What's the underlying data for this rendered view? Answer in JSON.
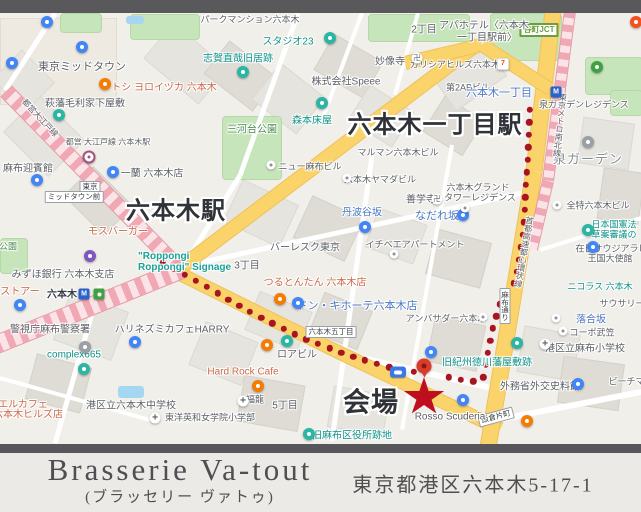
{
  "footer": {
    "name": "Brasserie Va-tout",
    "kana": "(ブラッセリー ヴァトゥ)",
    "address": "東京都港区六本木5-17-1"
  },
  "map": {
    "big_labels": [
      {
        "text": "六本木一丁目駅",
        "x": 435,
        "y": 122,
        "size": 24
      },
      {
        "text": "六本木駅",
        "x": 176,
        "y": 208,
        "size": 24
      },
      {
        "text": "会場",
        "x": 371,
        "y": 400,
        "size": 27
      }
    ],
    "signage": {
      "lines": [
        "\"Roppongi",
        "Roppongi\" Signage"
      ],
      "x": 138,
      "y": 251,
      "color": "#18a295"
    },
    "labels": [
      [
        "パークマンション六本木",
        250,
        19,
        "g",
        9
      ],
      [
        "東京ミッドタウン",
        82,
        66,
        "g",
        11
      ],
      [
        "トシ ヨロイヅカ 六本木",
        164,
        86,
        "o",
        10
      ],
      [
        "萩藩毛利家下屋敷",
        85,
        102,
        "g",
        10
      ],
      [
        "志賀直哉旧居跡",
        238,
        57,
        "t",
        10
      ],
      [
        "スタジオ23",
        288,
        40,
        "t",
        10
      ],
      [
        "妙像寺",
        390,
        60,
        "g",
        10
      ],
      [
        "株式会社Speee",
        346,
        80,
        "g",
        10
      ],
      [
        "2丁目",
        424,
        28,
        "g",
        10
      ],
      [
        "アパホテル〈六本木",
        484,
        24,
        "g",
        10
      ],
      [
        "一丁目駅前〉",
        487,
        36,
        "g",
        10
      ],
      [
        "ガリシアヒルズ六本木",
        455,
        64,
        "g",
        9
      ],
      [
        "第2ABビル",
        468,
        87,
        "g",
        9
      ],
      [
        "六本木一丁目",
        499,
        92,
        "b",
        11
      ],
      [
        "泉ガーデンレジデンス",
        584,
        104,
        "g",
        9
      ],
      [
        "泉ガーデン",
        588,
        158,
        "area",
        13
      ],
      [
        "全特六本木ビル",
        598,
        205,
        "g",
        9
      ],
      [
        "日本国憲法",
        614,
        224,
        "t",
        9
      ],
      [
        "草案審議の",
        614,
        234,
        "t",
        9
      ],
      [
        "在日サウジアラビア",
        616,
        248,
        "g",
        9
      ],
      [
        "王国大使館",
        610,
        258,
        "g",
        9
      ],
      [
        "ニコラス 六本木",
        600,
        286,
        "t",
        9
      ],
      [
        "サウサリー",
        622,
        303,
        "g",
        9
      ],
      [
        "落合坂",
        591,
        318,
        "b",
        10
      ],
      [
        "コーポ武笠",
        592,
        332,
        "g",
        9
      ],
      [
        "港区立麻布小学校",
        585,
        347,
        "g",
        10
      ],
      [
        "外務省外交史料館",
        540,
        385,
        "g",
        10
      ],
      [
        "ビーチマン",
        631,
        381,
        "g",
        9
      ],
      [
        "麻布迎賓館",
        28,
        167,
        "g",
        10
      ],
      [
        "都営 大江戸線 六本木駅",
        108,
        142,
        "g",
        8
      ],
      [
        "一蘭 六本木店",
        152,
        172,
        "g",
        10
      ],
      [
        "モスバーガー",
        118,
        230,
        "o",
        10
      ],
      [
        "みずほ銀行 六本木支店",
        63,
        273,
        "g",
        10
      ],
      [
        "ストアー",
        20,
        290,
        "o",
        10
      ],
      [
        "六本木",
        62,
        293,
        "st",
        10
      ],
      [
        "警視庁麻布警察署",
        50,
        328,
        "g",
        10
      ],
      [
        "complex665",
        74,
        355,
        "t",
        10
      ],
      [
        "ハリネズミカフェHARRY",
        172,
        328,
        "g",
        10
      ],
      [
        "エルカフェ",
        23,
        403,
        "o",
        10
      ],
      [
        "六本木ヒルズ店",
        28,
        413,
        "o",
        10
      ],
      [
        "港区立六本木中学校",
        131,
        404,
        "g",
        10
      ],
      [
        "東洋英和女学院小学部",
        210,
        417,
        "g",
        9
      ],
      [
        "三河台公園",
        252,
        128,
        "grn",
        10
      ],
      [
        "森本床屋",
        312,
        119,
        "t",
        10
      ],
      [
        "ニュー麻布ビル",
        310,
        166,
        "g",
        9
      ],
      [
        "マルマン六本木ビル",
        398,
        152,
        "g",
        9
      ],
      [
        "六本木ヤマダビル",
        380,
        179,
        "g",
        9
      ],
      [
        "丹波谷坂",
        362,
        211,
        "b",
        10
      ],
      [
        "善学寺",
        421,
        198,
        "g",
        10
      ],
      [
        "なだれ坂",
        437,
        215,
        "b",
        11
      ],
      [
        "六本木グランド",
        478,
        187,
        "g",
        9
      ],
      [
        "タワーレジデンス",
        480,
        197,
        "g",
        9
      ],
      [
        "イチベエアパートメント",
        415,
        244,
        "g",
        9
      ],
      [
        "バーレスク東京",
        305,
        246,
        "g",
        10
      ],
      [
        "3丁目",
        247,
        264,
        "g",
        10
      ],
      [
        "つるとんたん 六本木店",
        315,
        281,
        "o",
        10
      ],
      [
        "ドン・キホーテ六本木店",
        357,
        305,
        "b",
        11
      ],
      [
        "アンバサダー六本木",
        446,
        318,
        "g",
        9
      ],
      [
        "ロアビル",
        297,
        353,
        "g",
        10
      ],
      [
        "Hard Rock Cafe",
        243,
        372,
        "o",
        10
      ],
      [
        "福龍",
        255,
        399,
        "g",
        9
      ],
      [
        "5丁目",
        285,
        404,
        "g",
        10
      ],
      [
        "旧麻布区役所跡地",
        352,
        434,
        "t",
        10
      ],
      [
        "Rosso Scuderia",
        450,
        417,
        "g",
        10
      ],
      [
        "旧紀州徳川藩屋敷跡",
        487,
        361,
        "t",
        10
      ],
      [
        "公園",
        8,
        246,
        "grn",
        9
      ],
      [
        "都営大江戸線",
        40,
        118,
        "g",
        8,
        47
      ],
      [
        "東京メトロ南北線",
        560,
        125,
        "g",
        8,
        6,
        true
      ],
      [
        "首都高速都心環状線",
        524,
        252,
        "g",
        8,
        10,
        true
      ]
    ],
    "boxes": [
      {
        "text": "谷町JCT",
        "x": 539,
        "y": 30,
        "cls": "jct"
      },
      {
        "text": "東京",
        "x": 90,
        "y": 187
      },
      {
        "text": "ミッドタウン前",
        "x": 74,
        "y": 197
      },
      {
        "text": "六本木五丁目",
        "x": 331,
        "y": 332
      },
      {
        "text": "飯倉片町",
        "x": 496,
        "y": 417,
        "rot": -15
      },
      {
        "text": "麻布通り",
        "x": 505,
        "y": 306,
        "vert": true
      }
    ],
    "pins": [
      [
        "blue",
        47,
        22
      ],
      [
        "blue",
        82,
        47
      ],
      [
        "blue",
        12,
        63
      ],
      [
        "blue",
        37,
        180
      ],
      [
        "blue",
        113,
        172
      ],
      [
        "blue",
        135,
        342
      ],
      [
        "blue",
        431,
        352
      ],
      [
        "blue",
        593,
        247
      ],
      [
        "blue",
        578,
        384
      ],
      [
        "blue",
        463,
        400
      ],
      [
        "blue",
        365,
        227
      ],
      [
        "blue",
        463,
        215
      ],
      [
        "blue",
        298,
        303
      ],
      [
        "paw",
        20,
        305
      ],
      [
        "teal",
        59,
        115
      ],
      [
        "teal",
        243,
        72
      ],
      [
        "cam",
        330,
        38
      ],
      [
        "teal",
        322,
        103
      ],
      [
        "teal",
        287,
        341
      ],
      [
        "teal",
        84,
        369
      ],
      [
        "teal",
        309,
        434
      ],
      [
        "teal",
        517,
        343
      ],
      [
        "teal",
        588,
        230
      ],
      [
        "orange",
        105,
        84
      ],
      [
        "orange",
        280,
        299
      ],
      [
        "orange",
        267,
        345
      ],
      [
        "orange",
        258,
        386
      ],
      [
        "orange",
        527,
        421
      ],
      [
        "ocircle",
        636,
        22
      ],
      [
        "purple",
        90,
        256
      ],
      [
        "dot",
        271,
        165
      ],
      [
        "dot",
        347,
        178
      ],
      [
        "dot",
        465,
        208
      ],
      [
        "dot",
        394,
        254
      ],
      [
        "dot",
        483,
        317
      ],
      [
        "dot",
        563,
        331
      ],
      [
        "dot",
        557,
        205
      ],
      [
        "dot",
        556,
        318
      ],
      [
        "gray",
        85,
        347
      ],
      [
        "gray",
        588,
        142
      ],
      [
        "manji",
        417,
        58
      ],
      [
        "manji",
        437,
        199
      ],
      [
        "seven",
        503,
        64
      ],
      [
        "school",
        155,
        418
      ],
      [
        "school",
        243,
        401
      ],
      [
        "school",
        545,
        344
      ],
      [
        "metro",
        556,
        92
      ],
      [
        "metro",
        84,
        294
      ],
      [
        "entrance",
        99,
        294
      ],
      [
        "oedo",
        89,
        157
      ],
      [
        "greenstation",
        597,
        67
      ]
    ],
    "routes": [
      {
        "color": "#a81420",
        "r": 3.2,
        "spacing": 12.5,
        "points": [
          [
            530,
            110
          ],
          [
            527,
            170
          ],
          [
            523,
            235
          ],
          [
            516,
            280
          ],
          [
            500,
            303
          ],
          [
            492,
            332
          ],
          [
            487,
            358
          ],
          [
            483,
            380
          ],
          [
            470,
            382
          ],
          [
            438,
            375
          ]
        ]
      },
      {
        "color": "#a81420",
        "r": 3.2,
        "spacing": 12.5,
        "points": [
          [
            152,
            257
          ],
          [
            200,
            283
          ],
          [
            250,
            312
          ],
          [
            300,
            337
          ],
          [
            336,
            351
          ],
          [
            370,
            362
          ],
          [
            400,
            370
          ],
          [
            415,
            372
          ]
        ]
      }
    ],
    "roads": [
      [
        178,
        268,
        478,
        42,
        13
      ],
      [
        178,
        272,
        336,
        350,
        12
      ],
      [
        336,
        350,
        500,
        428,
        12
      ],
      [
        553,
        10,
        534,
        170,
        15
      ],
      [
        534,
        170,
        488,
        446,
        15
      ],
      [
        405,
        62,
        482,
        44,
        12
      ],
      [
        482,
        44,
        550,
        88,
        12
      ]
    ],
    "rails": [
      [
        6,
        90,
        182,
        270,
        14
      ],
      [
        -6,
        344,
        182,
        268,
        17
      ],
      [
        570,
        10,
        548,
        180,
        10
      ],
      [
        548,
        180,
        532,
        248,
        10
      ]
    ],
    "streets": [
      [
        55,
        13,
        5,
        90,
        5
      ],
      [
        298,
        13,
        240,
        175,
        5
      ],
      [
        240,
        175,
        182,
        268,
        5
      ],
      [
        362,
        13,
        322,
        120,
        4
      ],
      [
        418,
        13,
        395,
        95,
        4
      ],
      [
        182,
        266,
        525,
        192,
        5
      ],
      [
        372,
        155,
        332,
        440,
        5
      ],
      [
        452,
        145,
        402,
        430,
        4
      ],
      [
        336,
        352,
        500,
        390,
        6
      ],
      [
        100,
        285,
        55,
        443,
        5
      ],
      [
        497,
        420,
        641,
        392,
        6
      ],
      [
        0,
        378,
        150,
        420,
        4
      ],
      [
        540,
        250,
        641,
        218,
        4
      ]
    ],
    "parks": [
      [
        368,
        14,
        100,
        26
      ],
      [
        490,
        13,
        70,
        46
      ],
      [
        130,
        14,
        68,
        24
      ],
      [
        222,
        116,
        58,
        62
      ],
      [
        585,
        57,
        56,
        36
      ],
      [
        0,
        238,
        26,
        34
      ],
      [
        60,
        13,
        40,
        18
      ],
      [
        610,
        90,
        31,
        24
      ]
    ],
    "water": [
      [
        126,
        16,
        18,
        8
      ],
      [
        118,
        386,
        26,
        12
      ]
    ],
    "buildings": [
      [
        0,
        18,
        115,
        85,
        0,
        3
      ],
      [
        12,
        110,
        62,
        50,
        45,
        1
      ],
      [
        70,
        180,
        55,
        40,
        45,
        2
      ],
      [
        0,
        60,
        45,
        40,
        45,
        1
      ],
      [
        150,
        40,
        70,
        45,
        40,
        1
      ],
      [
        210,
        55,
        60,
        40,
        38,
        2
      ],
      [
        260,
        75,
        55,
        45,
        38,
        1
      ],
      [
        320,
        45,
        55,
        40,
        30,
        2
      ],
      [
        355,
        95,
        50,
        40,
        32,
        1
      ],
      [
        430,
        105,
        45,
        40,
        32,
        2
      ],
      [
        230,
        190,
        60,
        45,
        25,
        1
      ],
      [
        300,
        205,
        55,
        45,
        25,
        2
      ],
      [
        370,
        215,
        50,
        40,
        20,
        1
      ],
      [
        430,
        235,
        55,
        45,
        15,
        2
      ],
      [
        250,
        300,
        55,
        40,
        22,
        1
      ],
      [
        315,
        300,
        50,
        40,
        22,
        2
      ],
      [
        195,
        330,
        55,
        45,
        22,
        1
      ],
      [
        240,
        380,
        60,
        45,
        10,
        2
      ],
      [
        330,
        390,
        55,
        40,
        10,
        1
      ],
      [
        430,
        320,
        50,
        45,
        12,
        2
      ],
      [
        520,
        330,
        55,
        45,
        10,
        1
      ],
      [
        560,
        360,
        60,
        45,
        8,
        2
      ],
      [
        580,
        120,
        50,
        45,
        8,
        1
      ],
      [
        600,
        170,
        40,
        50,
        8,
        2
      ],
      [
        60,
        300,
        60,
        50,
        20,
        1
      ],
      [
        30,
        360,
        55,
        45,
        15,
        2
      ],
      [
        440,
        60,
        60,
        35,
        -35,
        1
      ]
    ],
    "venue": {
      "pin": [
        424,
        366
      ],
      "star": [
        424,
        397
      ],
      "bluebox": [
        398,
        372
      ]
    }
  }
}
